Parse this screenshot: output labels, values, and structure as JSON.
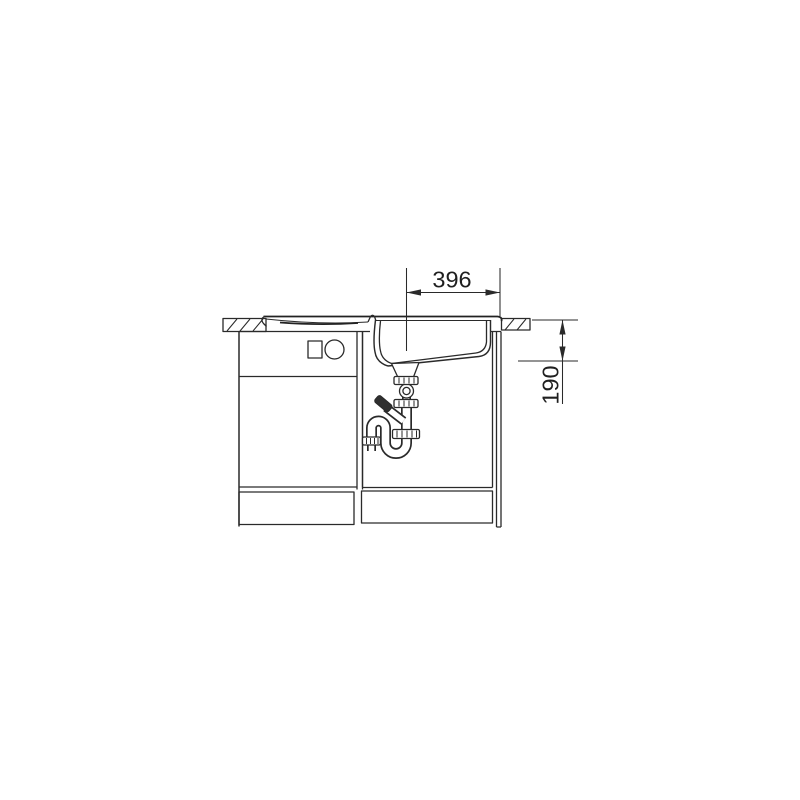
{
  "page": {
    "background_color": "#ffffff"
  },
  "drawing": {
    "title": "Sink installation side section drawing",
    "line_color": "#2a2a2a",
    "dimension_width": {
      "value": "396"
    },
    "dimension_depth": {
      "value": "190"
    },
    "components": {
      "countertop": "countertop cross-section with diagonal hatching",
      "sink": "inset sink with drainboard and bowl",
      "siphon": "space-saving siphon drain trap",
      "cabinet": "base cabinet with door, drawer fronts and plinth drawers",
      "front_symbols": "square and circle symbols on upper drawer front"
    }
  }
}
